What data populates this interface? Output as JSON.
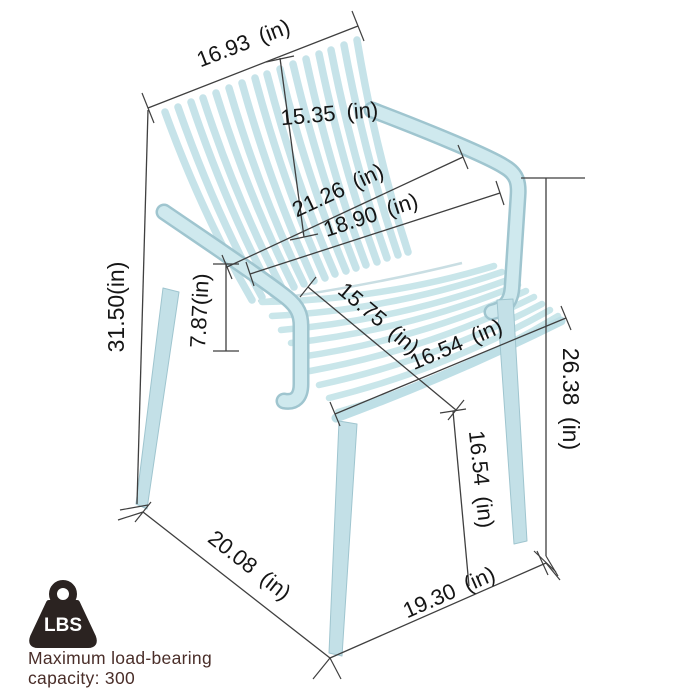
{
  "title": "Armchair dimension diagram",
  "colors": {
    "chair": "#c9e6ea",
    "chair_edge": "#9fc5cf",
    "dimension_line": "#3f3f3f",
    "dimension_label": "#151515",
    "caption_text": "#4a2e29",
    "badge": "#2b2321"
  },
  "dimensions": {
    "back_width": "16.93 (in)",
    "back_height": "15.35 (in)",
    "overall_height": "31.50(in)",
    "total_depth": "21.26 (in)",
    "inner_depth": "18.90 (in)",
    "armrest_above_seat": "7.87(in)",
    "seat_depth": "15.75 (in)",
    "seat_width": "16.54 (in)",
    "front_leg_height": "16.54 (in)",
    "armrest_to_floor": "26.38 (in)",
    "base_depth": "20.08 (in)",
    "base_width": "19.30 (in)"
  },
  "load_badge": {
    "unit_label": "LBS",
    "caption_line1": "Maximum load-bearing",
    "caption_line2": "capacity: 300"
  }
}
